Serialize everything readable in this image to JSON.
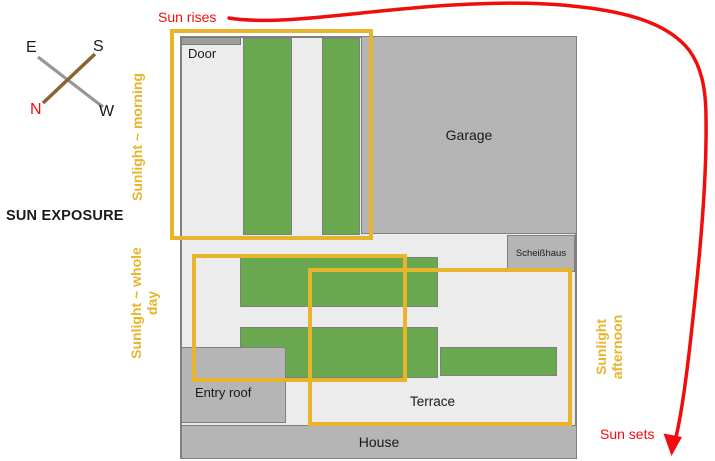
{
  "title": "SUN EXPOSURE",
  "compass": {
    "east": "E",
    "south": "S",
    "north": "N",
    "west": "W"
  },
  "sun": {
    "rises": "Sun rises",
    "sets": "Sun sets"
  },
  "zones": {
    "morning": {
      "label": "Sunlight ~ morning"
    },
    "whole_day": {
      "label_line1": "Sunlight ~ whole",
      "label_line2": "day"
    },
    "afternoon": {
      "label_line1": "Sunlight",
      "label_line2": "afternoon"
    }
  },
  "plan": {
    "door": "Door",
    "garage": "Garage",
    "scheisshaus": "Scheißhaus",
    "entry_roof": "Entry roof",
    "terrace": "Terrace",
    "house": "House"
  },
  "colors": {
    "accent-yellow": "#E8B42C",
    "sun-red": "#F20D0D",
    "bed-green": "#6AA84F",
    "building-gray": "#B5B5B5",
    "plot-gray": "#ECECEC",
    "border-gray": "#808080",
    "threshold-gray": "#9C9C9C",
    "compass-brown": "#8A6532",
    "compass-gray": "#969696",
    "text-black": "#1A1A1A"
  }
}
